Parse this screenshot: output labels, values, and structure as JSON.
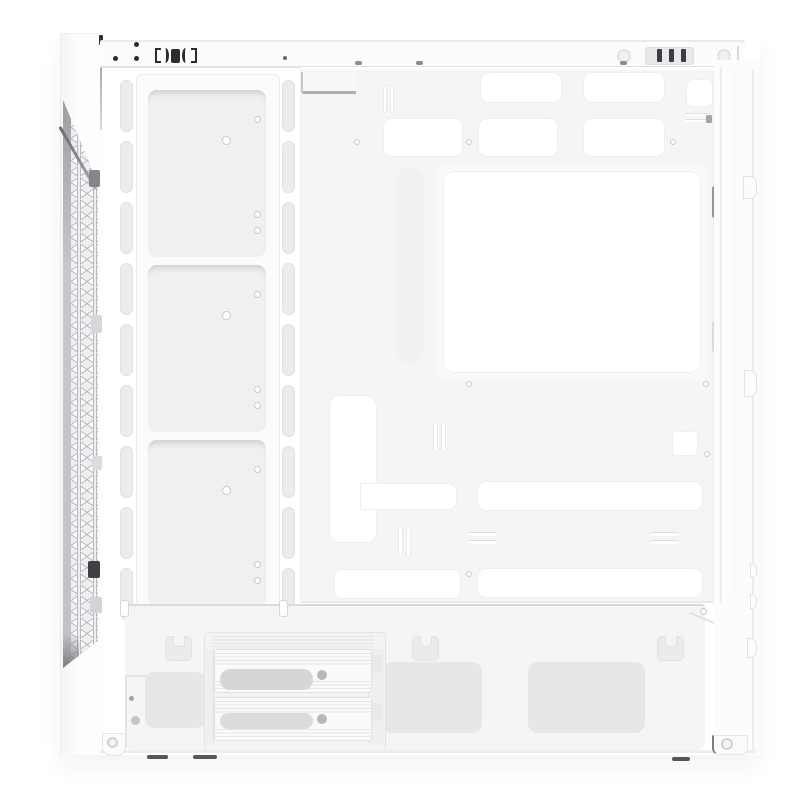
{
  "meta": {
    "kind": "product-photo",
    "subject": "White mid-tower ATX PC case, side view with side panel removed, interior visible",
    "visible_text": [],
    "orientation": "front panel on left, rear panel on right, PSU shroud at bottom"
  },
  "palette": {
    "page-bg": "#ffffff",
    "case-white": "#fcfcfd",
    "panel": "#f5f5f6",
    "recess": "#f0f0f2",
    "vent": "#e7e7e9",
    "slot": "#ececee",
    "cut": "#ffffff",
    "line-soft": "#efeff1",
    "mesh-bg": "#efeff1",
    "mesh-line": "#b7b7bb",
    "dark": "#2b2b30",
    "screw": "#c9c9cd",
    "shadow": "#55555a"
  },
  "parts": {
    "top_bar": {
      "label": "top panel edge",
      "io_glyphs": "bracket, paren, solid block, paren, bracket (top I/O seen edge-on)",
      "vent_grille_bars": 3,
      "thumbscrews": 2
    },
    "front_panel": {
      "label": "front panel",
      "mesh": "triangular lattice vent strip, slanted top and bottom",
      "retention_clips": 5
    },
    "fan_rail": {
      "label": "front fan / radiator mounting rail",
      "recessed_sections": 3,
      "slot_columns": 2,
      "slots_per_column": 9
    },
    "motherboard_tray": {
      "label": "motherboard tray",
      "cable_grommet_cutouts_top_row": 3,
      "cable_grommet_cutouts_second_row": 3,
      "cpu_cooler_cutout": 1,
      "vertical_cable_cutout": 1,
      "horizontal_cable_cutouts": 2,
      "bottom_cable_cutouts": 2,
      "small_square_cutout": 1,
      "standoff_screw_dots": 7
    },
    "psu_shroud": {
      "label": "power supply shroud",
      "fan_brackets": 3,
      "mesh_vents": 3
    },
    "drive_cage": {
      "label": "HDD drive cage",
      "trays": 2,
      "tray_features": "ribbed texture, gray oval recess, screw dot"
    },
    "rear_panel": {
      "label": "rear panel edge",
      "tabs": 4,
      "slots": 3
    },
    "feet": {
      "count": 2,
      "shadow_dashes": 3
    }
  }
}
